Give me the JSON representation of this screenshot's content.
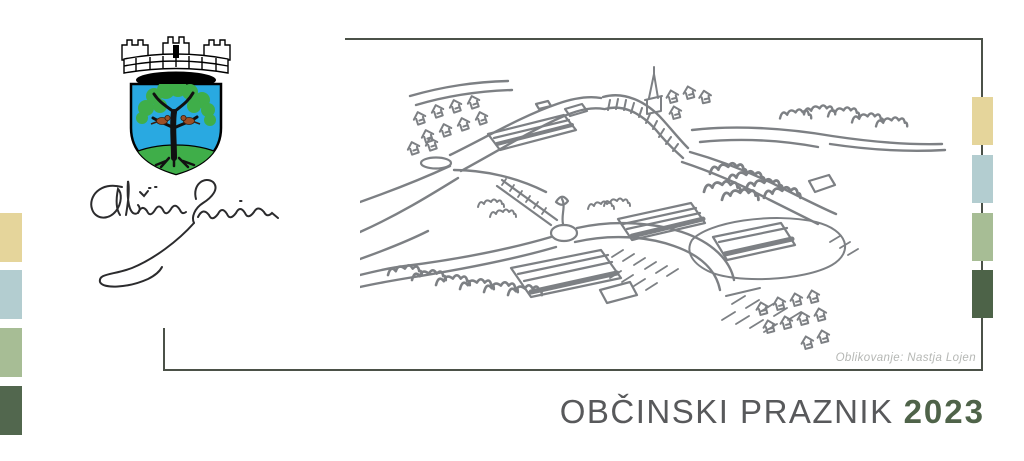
{
  "branding": {
    "municipality": "Občina Sevnica",
    "signature_text": "Občina Sevnica",
    "coat_of_arms": "sevnica-coat-of-arms"
  },
  "title": {
    "label": "OBČINSKI PRAZNIK",
    "year": "2023"
  },
  "credit": {
    "text": "Oblikovanje: Nastja Lojen"
  },
  "colors": {
    "title_gray": "#58595b",
    "title_green": "#4f6349",
    "frame": "#4b5148",
    "sketch_stroke": "#7d8084",
    "credit_gray": "#b5b7b4",
    "crest_blue": "#29a9e1",
    "crest_green": "#3fae49",
    "crest_bird_brown": "#9c4f26"
  },
  "palette_left": [
    {
      "name": "tan",
      "color": "#e5d59b"
    },
    {
      "name": "light-blue",
      "color": "#b3cdd0"
    },
    {
      "name": "sage",
      "color": "#a7bd95"
    },
    {
      "name": "dark-green",
      "color": "#52674e"
    }
  ],
  "palette_right": [
    {
      "name": "tan",
      "color": "#e5d59b"
    },
    {
      "name": "light-blue",
      "color": "#b3cdd0"
    },
    {
      "name": "sage",
      "color": "#a7bd95"
    },
    {
      "name": "dark-green",
      "color": "#4d6348"
    }
  ]
}
